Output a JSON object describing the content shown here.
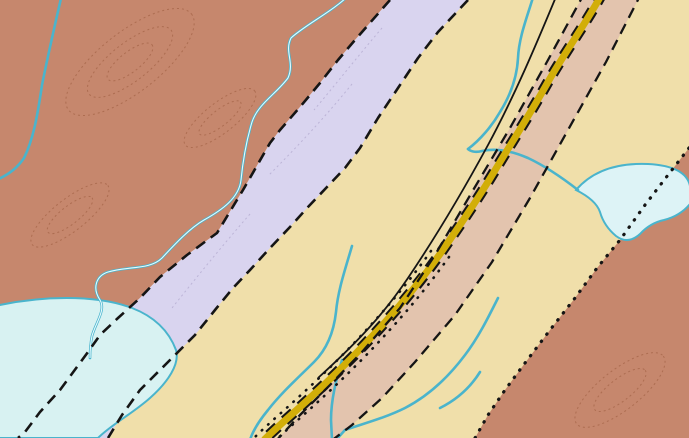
{
  "map": {
    "colors": {
      "oce_brown": "#c6876d",
      "osc_tan": "#f0dfaa",
      "scm_lavender": "#d9d4ef",
      "oscv_corridor": "#e3c4ae",
      "road_yellow": "#d2ae08",
      "water": "#d8f2f2",
      "water_line": "#4ab4cc",
      "contour_brown": "#9a5a38",
      "contact_black": "#151515",
      "red_accent": "#d32015",
      "label_gray": "#8e8c84"
    },
    "unit_labels": [
      {
        "t": "Oce",
        "x": 38,
        "y": 263,
        "s": 22
      },
      {
        "t": "scm",
        "x": 224,
        "y": 266,
        "s": 19
      },
      {
        "t": "Osc",
        "x": 410,
        "y": 178,
        "s": 22
      },
      {
        "t": "Osc",
        "x": 601,
        "y": 143,
        "s": 22
      },
      {
        "t": "Oscg",
        "x": 484,
        "y": 290,
        "s": 22
      },
      {
        "t": "Oscv",
        "x": 464,
        "y": 315,
        "s": 22
      },
      {
        "t": "Oce",
        "x": 645,
        "y": 319,
        "s": 22
      }
    ],
    "water_labels": [
      {
        "t": "Black",
        "x": 214,
        "y": 126,
        "r": -38
      },
      {
        "t": "avel",
        "x": 20,
        "y": 394,
        "r": -6
      }
    ],
    "locality": {
      "label": "10",
      "x": 178,
      "y": 404
    },
    "measurements": [
      {
        "v": "82",
        "x": 30,
        "y": 16
      },
      {
        "v": "78",
        "x": 146,
        "y": 8
      },
      {
        "v": "20",
        "x": 252,
        "y": 10
      },
      {
        "v": "81",
        "x": 222,
        "y": 27
      },
      {
        "v": "70",
        "x": 263,
        "y": 27
      },
      {
        "v": "72",
        "x": 124,
        "y": 96
      },
      {
        "v": "40",
        "x": 68,
        "y": 108
      },
      {
        "v": "73",
        "x": 62,
        "y": 133
      },
      {
        "v": "83",
        "x": 140,
        "y": 147
      },
      {
        "v": "84",
        "x": 87,
        "y": 161
      },
      {
        "v": "86",
        "x": 116,
        "y": 170
      },
      {
        "v": "88",
        "x": 122,
        "y": 205
      },
      {
        "v": "60",
        "x": 299,
        "y": 140
      },
      {
        "v": "68",
        "x": 342,
        "y": 140
      },
      {
        "v": "89",
        "x": 364,
        "y": 127
      },
      {
        "v": "21",
        "x": 387,
        "y": 110
      },
      {
        "v": "76",
        "x": 399,
        "y": 73
      },
      {
        "v": "89",
        "x": 437,
        "y": 120
      },
      {
        "v": "80",
        "x": 474,
        "y": 13
      },
      {
        "v": "80",
        "x": 462,
        "y": 34
      },
      {
        "v": "70",
        "x": 527,
        "y": 10
      },
      {
        "v": "42",
        "x": 530,
        "y": 25
      },
      {
        "v": "37",
        "x": 596,
        "y": 17
      },
      {
        "v": "74",
        "x": 581,
        "y": 32
      },
      {
        "v": "73",
        "x": 643,
        "y": 11
      },
      {
        "v": "33",
        "x": 656,
        "y": 25
      },
      {
        "v": "73",
        "x": 681,
        "y": 30
      },
      {
        "v": "62",
        "x": 670,
        "y": 44
      },
      {
        "v": "78",
        "x": 634,
        "y": 55
      },
      {
        "v": "82",
        "x": 517,
        "y": 52
      },
      {
        "v": "19",
        "x": 560,
        "y": 67
      },
      {
        "v": "84",
        "x": 528,
        "y": 115
      },
      {
        "v": "43",
        "x": 585,
        "y": 110
      },
      {
        "v": "76",
        "x": 571,
        "y": 126
      },
      {
        "v": "84",
        "x": 499,
        "y": 132
      },
      {
        "v": "50",
        "x": 315,
        "y": 194
      },
      {
        "v": "58",
        "x": 359,
        "y": 179
      },
      {
        "v": "82",
        "x": 290,
        "y": 215
      },
      {
        "v": "88",
        "x": 359,
        "y": 215
      },
      {
        "v": "10",
        "x": 263,
        "y": 234
      },
      {
        "v": "86",
        "x": 249,
        "y": 252
      },
      {
        "v": "75",
        "x": 369,
        "y": 234
      },
      {
        "v": "60",
        "x": 399,
        "y": 224
      },
      {
        "v": "70",
        "x": 429,
        "y": 215
      },
      {
        "v": "76",
        "x": 367,
        "y": 256
      },
      {
        "v": "20",
        "x": 463,
        "y": 198
      },
      {
        "v": "84",
        "x": 517,
        "y": 214
      },
      {
        "v": "64",
        "x": 467,
        "y": 246
      },
      {
        "v": "88",
        "x": 500,
        "y": 243
      },
      {
        "v": "75",
        "x": 322,
        "y": 288
      },
      {
        "v": "65",
        "x": 176,
        "y": 292
      },
      {
        "v": "80",
        "x": 167,
        "y": 312
      },
      {
        "v": "85",
        "x": 216,
        "y": 317
      },
      {
        "v": "86",
        "x": 190,
        "y": 340
      },
      {
        "v": "78",
        "x": 221,
        "y": 342
      },
      {
        "v": "56",
        "x": 242,
        "y": 338
      },
      {
        "v": "84",
        "x": 212,
        "y": 370
      },
      {
        "v": "87",
        "x": 222,
        "y": 383
      },
      {
        "v": "87",
        "x": 245,
        "y": 400
      },
      {
        "v": "66",
        "x": 25,
        "y": 423
      },
      {
        "v": "80",
        "x": 52,
        "y": 430
      },
      {
        "v": "80",
        "x": 567,
        "y": 370
      },
      {
        "v": "77",
        "x": 548,
        "y": 398
      },
      {
        "v": "50",
        "x": 545,
        "y": 427
      },
      {
        "v": "54",
        "x": 655,
        "y": 374
      },
      {
        "v": "2",
        "x": 686,
        "y": 381
      },
      {
        "v": "13",
        "x": 640,
        "y": 400
      },
      {
        "v": "80",
        "x": 643,
        "y": 417
      },
      {
        "v": "73",
        "x": 657,
        "y": 437
      }
    ],
    "symbols": [
      {
        "k": "arrow",
        "x": 48,
        "y": 28,
        "r": -50
      },
      {
        "k": "sd",
        "x": 152,
        "y": 22,
        "r": -42
      },
      {
        "k": "sd",
        "x": 168,
        "y": 14,
        "r": -42
      },
      {
        "k": "arrow",
        "x": 240,
        "y": 32,
        "r": -45
      },
      {
        "k": "sd",
        "x": 268,
        "y": 42,
        "r": -42
      },
      {
        "k": "sd",
        "x": 88,
        "y": 126,
        "r": -48
      },
      {
        "k": "sd",
        "x": 138,
        "y": 106,
        "r": -42
      },
      {
        "k": "arrow",
        "x": 126,
        "y": 153,
        "r": -40
      },
      {
        "k": "sd",
        "x": 104,
        "y": 176,
        "r": -42
      },
      {
        "k": "sd",
        "x": 126,
        "y": 216,
        "r": -40
      },
      {
        "k": "sd",
        "x": 348,
        "y": 136,
        "r": -42
      },
      {
        "k": "arrow",
        "x": 384,
        "y": 96,
        "r": -80
      },
      {
        "k": "sd",
        "x": 449,
        "y": 106,
        "r": -42
      },
      {
        "k": "sd",
        "x": 488,
        "y": 30,
        "r": -42
      },
      {
        "k": "arrow",
        "x": 523,
        "y": 44,
        "r": -85
      },
      {
        "k": "sd",
        "x": 604,
        "y": 30,
        "r": -42
      },
      {
        "k": "arrow",
        "x": 653,
        "y": 40,
        "r": -42
      },
      {
        "k": "diamond",
        "x": 664,
        "y": 52,
        "r": 0
      },
      {
        "k": "diamond",
        "x": 600,
        "y": 46,
        "r": 0
      },
      {
        "k": "sd",
        "x": 640,
        "y": 62,
        "r": -42
      },
      {
        "k": "sd",
        "x": 523,
        "y": 62,
        "r": -42
      },
      {
        "k": "sd",
        "x": 560,
        "y": 82,
        "r": -85
      },
      {
        "k": "arrow",
        "x": 601,
        "y": 101,
        "r": -42
      },
      {
        "k": "sd",
        "x": 506,
        "y": 142,
        "r": -42
      },
      {
        "k": "diamond",
        "x": 497,
        "y": 133,
        "r": 0
      },
      {
        "k": "arrow",
        "x": 470,
        "y": 210,
        "r": -85
      },
      {
        "k": "sd",
        "x": 523,
        "y": 226,
        "r": -42
      },
      {
        "k": "sd",
        "x": 472,
        "y": 252,
        "r": -42
      },
      {
        "k": "sd",
        "x": 504,
        "y": 254,
        "r": -42
      },
      {
        "k": "arrow",
        "x": 318,
        "y": 200,
        "r": -45
      },
      {
        "k": "arrow",
        "x": 354,
        "y": 202,
        "r": -85
      },
      {
        "k": "sd",
        "x": 348,
        "y": 216,
        "r": -42
      },
      {
        "k": "sd",
        "x": 296,
        "y": 226,
        "r": -42
      },
      {
        "k": "sd",
        "x": 372,
        "y": 242,
        "r": -42
      },
      {
        "k": "sd",
        "x": 404,
        "y": 236,
        "r": -42
      },
      {
        "k": "sd",
        "x": 434,
        "y": 228,
        "r": -42
      },
      {
        "k": "sd",
        "x": 388,
        "y": 268,
        "r": -42
      },
      {
        "k": "arrow",
        "x": 272,
        "y": 246,
        "r": -85
      },
      {
        "k": "sd",
        "x": 262,
        "y": 272,
        "r": -42
      },
      {
        "k": "sd",
        "x": 336,
        "y": 296,
        "r": -42
      },
      {
        "k": "tri",
        "x": 508,
        "y": 204,
        "r": -130
      },
      {
        "k": "tri",
        "x": 458,
        "y": 237,
        "r": -130
      },
      {
        "k": "tri",
        "x": 481,
        "y": 239,
        "r": -130
      },
      {
        "k": "sd",
        "x": 188,
        "y": 298,
        "r": -42
      },
      {
        "k": "sd",
        "x": 180,
        "y": 320,
        "r": -42
      },
      {
        "k": "bar",
        "x": 205,
        "y": 320,
        "r": -42
      },
      {
        "k": "sd",
        "x": 204,
        "y": 352,
        "r": -42
      },
      {
        "k": "arrow",
        "x": 232,
        "y": 344,
        "r": -45
      },
      {
        "k": "arrow",
        "x": 236,
        "y": 378,
        "r": -45
      },
      {
        "k": "sd",
        "x": 256,
        "y": 406,
        "r": -42
      },
      {
        "k": "sd",
        "x": 36,
        "y": 430,
        "r": -42
      },
      {
        "k": "sd",
        "x": 62,
        "y": 434,
        "r": -42
      },
      {
        "k": "sd",
        "x": 576,
        "y": 380,
        "r": -42
      },
      {
        "k": "sd",
        "x": 556,
        "y": 404,
        "r": -42
      },
      {
        "k": "sd",
        "x": 552,
        "y": 432,
        "r": -42
      },
      {
        "k": "arrow",
        "x": 662,
        "y": 388,
        "r": 135
      },
      {
        "k": "sd",
        "x": 686,
        "y": 392,
        "r": -42
      },
      {
        "k": "sd",
        "x": 650,
        "y": 426,
        "r": -42
      },
      {
        "k": "sd",
        "x": 664,
        "y": 438,
        "r": -42
      }
    ],
    "station_dots": [
      [
        142,
        94
      ],
      [
        330,
        108
      ],
      [
        520,
        38
      ],
      [
        526,
        121
      ],
      [
        596,
        100
      ],
      [
        495,
        188
      ],
      [
        514,
        193
      ],
      [
        273,
        222
      ],
      [
        420,
        241
      ],
      [
        367,
        270
      ],
      [
        352,
        216
      ],
      [
        567,
        376
      ],
      [
        240,
        358
      ],
      [
        448,
        92
      ],
      [
        612,
        20
      ],
      [
        648,
        45
      ]
    ],
    "leaders": [
      {
        "pts": [
          [
            329,
            112
          ],
          [
            329,
            128
          ],
          [
            306,
            150
          ]
        ]
      },
      {
        "pts": [
          [
            401,
            80
          ],
          [
            401,
            96
          ],
          [
            418,
            110
          ]
        ]
      },
      {
        "pts": [
          [
            466,
            284
          ],
          [
            446,
            269
          ]
        ]
      },
      {
        "pts": [
          [
            439,
            275
          ],
          [
            452,
            261
          ]
        ]
      },
      {
        "pts": [
          [
            448,
            310
          ],
          [
            429,
            296
          ]
        ]
      },
      {
        "pts": [
          [
            422,
            302
          ],
          [
            435,
            288
          ]
        ]
      },
      {
        "pts": [
          [
            197,
            390
          ],
          [
            236,
            364
          ]
        ],
        "c": "red"
      }
    ],
    "section_lines": [
      {
        "y": 161,
        "x1": 0,
        "x2": 178
      },
      {
        "y": 208,
        "x1": 430,
        "x2": 690
      },
      {
        "y": 421,
        "x1": 330,
        "x2": 512
      }
    ]
  }
}
